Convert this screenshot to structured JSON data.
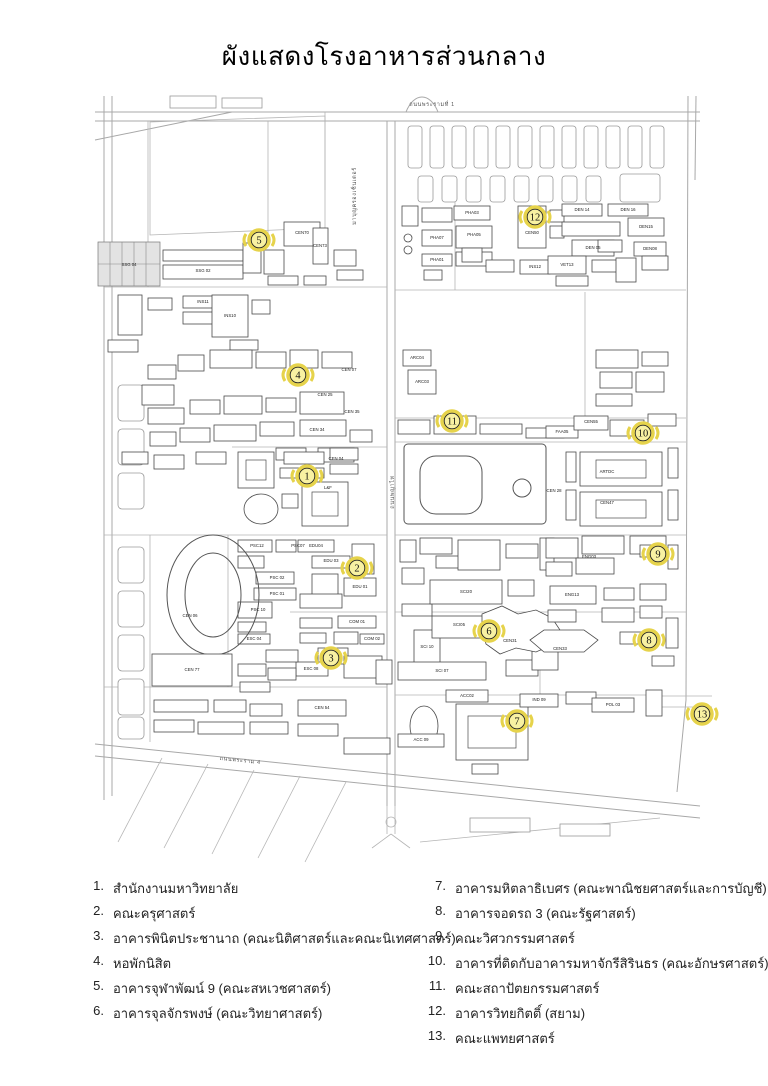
{
  "title": "ผังแสดงโรงอาหารส่วนกลาง",
  "colors": {
    "marker_fill": "#f8f1a2",
    "marker_ring": "#e6d34b",
    "marker_outline": "#222222",
    "road": "#a8a8a8",
    "ink": "#222222"
  },
  "map": {
    "street_labels": [
      {
        "text": "ถนนพระรามที่ 1",
        "x": 432,
        "y": 106,
        "rot": 0
      },
      {
        "text": "มาบุญครองเซ็นเตอร์",
        "x": 356,
        "y": 196,
        "rot": -90
      },
      {
        "text": "ถนนพญาไท",
        "x": 394,
        "y": 492,
        "rot": -90
      },
      {
        "text": "ถนนพระราม 4",
        "x": 240,
        "y": 762,
        "rot": 6
      }
    ],
    "building_labels": [
      {
        "text": "SSG 04",
        "x": 129,
        "y": 266
      },
      {
        "text": "SSG 02",
        "x": 203,
        "y": 272
      },
      {
        "text": "CEN70",
        "x": 302,
        "y": 234
      },
      {
        "text": "CEN73",
        "x": 320,
        "y": 247
      },
      {
        "text": "INS11",
        "x": 203,
        "y": 303
      },
      {
        "text": "INS10",
        "x": 230,
        "y": 317
      },
      {
        "text": "CEN 07",
        "x": 349,
        "y": 371
      },
      {
        "text": "CEN 25",
        "x": 325,
        "y": 396
      },
      {
        "text": "CEN 35",
        "x": 352,
        "y": 413
      },
      {
        "text": "CEN 34",
        "x": 317,
        "y": 431
      },
      {
        "text": "CEN 04",
        "x": 336,
        "y": 460
      },
      {
        "text": "L&F",
        "x": 328,
        "y": 489
      },
      {
        "text": "EDU04",
        "x": 316,
        "y": 547
      },
      {
        "text": "EDU 03",
        "x": 331,
        "y": 562
      },
      {
        "text": "EDU 01",
        "x": 360,
        "y": 588
      },
      {
        "text": "COM 01",
        "x": 357,
        "y": 623
      },
      {
        "text": "COM 02",
        "x": 372,
        "y": 640
      },
      {
        "text": "ESC 08",
        "x": 311,
        "y": 670
      },
      {
        "text": "CEN 54",
        "x": 322,
        "y": 709
      },
      {
        "text": "CEN 06",
        "x": 190,
        "y": 617
      },
      {
        "text": "CEN 77",
        "x": 192,
        "y": 671
      },
      {
        "text": "PSC12",
        "x": 257,
        "y": 547
      },
      {
        "text": "PSC07",
        "x": 298,
        "y": 547
      },
      {
        "text": "PSC 02",
        "x": 277,
        "y": 579
      },
      {
        "text": "PSC 01",
        "x": 277,
        "y": 595
      },
      {
        "text": "PSC 10",
        "x": 258,
        "y": 611
      },
      {
        "text": "ESC 04",
        "x": 254,
        "y": 640
      },
      {
        "text": "PHA03",
        "x": 472,
        "y": 214
      },
      {
        "text": "PHA07",
        "x": 437,
        "y": 239
      },
      {
        "text": "PHA05",
        "x": 474,
        "y": 236
      },
      {
        "text": "PHA01",
        "x": 437,
        "y": 261
      },
      {
        "text": "CEN50",
        "x": 532,
        "y": 234
      },
      {
        "text": "DEN 14",
        "x": 582,
        "y": 211
      },
      {
        "text": "DEN 16",
        "x": 628,
        "y": 211
      },
      {
        "text": "DEN15",
        "x": 646,
        "y": 228
      },
      {
        "text": "DEN08",
        "x": 650,
        "y": 250
      },
      {
        "text": "DEN 05",
        "x": 593,
        "y": 249
      },
      {
        "text": "VET13",
        "x": 567,
        "y": 266
      },
      {
        "text": "INS12",
        "x": 535,
        "y": 268
      },
      {
        "text": "ARC04",
        "x": 417,
        "y": 359
      },
      {
        "text": "ARC03",
        "x": 422,
        "y": 383
      },
      {
        "text": "CEN55",
        "x": 591,
        "y": 423
      },
      {
        "text": "FAA05",
        "x": 562,
        "y": 433
      },
      {
        "text": "CEN 28",
        "x": 554,
        "y": 492
      },
      {
        "text": "ARTDC",
        "x": 607,
        "y": 473
      },
      {
        "text": "CEN47",
        "x": 607,
        "y": 504
      },
      {
        "text": "SCI20",
        "x": 466,
        "y": 593
      },
      {
        "text": "SCI05",
        "x": 459,
        "y": 626
      },
      {
        "text": "SCI 10",
        "x": 427,
        "y": 648
      },
      {
        "text": "SCI 07",
        "x": 442,
        "y": 672
      },
      {
        "text": "CEN31",
        "x": 510,
        "y": 642
      },
      {
        "text": "ENG03",
        "x": 589,
        "y": 558
      },
      {
        "text": "ENG13",
        "x": 572,
        "y": 596
      },
      {
        "text": "CEN33",
        "x": 560,
        "y": 650
      },
      {
        "text": "ACC02",
        "x": 467,
        "y": 697
      },
      {
        "text": "ACC 09",
        "x": 421,
        "y": 741
      },
      {
        "text": "IND 09",
        "x": 539,
        "y": 701
      },
      {
        "text": "POL 03",
        "x": 613,
        "y": 706
      }
    ],
    "markers": [
      {
        "n": "1",
        "x": 307,
        "y": 476
      },
      {
        "n": "2",
        "x": 357,
        "y": 568
      },
      {
        "n": "3",
        "x": 331,
        "y": 658
      },
      {
        "n": "4",
        "x": 298,
        "y": 375
      },
      {
        "n": "5",
        "x": 259,
        "y": 240
      },
      {
        "n": "6",
        "x": 489,
        "y": 631
      },
      {
        "n": "7",
        "x": 517,
        "y": 721
      },
      {
        "n": "8",
        "x": 649,
        "y": 640
      },
      {
        "n": "9",
        "x": 658,
        "y": 554
      },
      {
        "n": "10",
        "x": 643,
        "y": 433
      },
      {
        "n": "11",
        "x": 452,
        "y": 421
      },
      {
        "n": "12",
        "x": 535,
        "y": 217
      },
      {
        "n": "13",
        "x": 702,
        "y": 714
      }
    ]
  },
  "legend": {
    "left": [
      {
        "n": "1.",
        "text": "สำนักงานมหาวิทยาลัย"
      },
      {
        "n": "2.",
        "text": "คณะครุศาสตร์"
      },
      {
        "n": "3.",
        "text": "อาคารพินิตประชานาถ (คณะนิติศาสตร์และคณะนิเทศศาสตร์)"
      },
      {
        "n": "4.",
        "text": "หอพักนิสิต"
      },
      {
        "n": "5.",
        "text": "อาคารจุฬาพัฒน์ 9 (คณะสหเวชศาสตร์)"
      },
      {
        "n": "6.",
        "text": "อาคารจุลจักรพงษ์ (คณะวิทยาศาสตร์)"
      }
    ],
    "right": [
      {
        "n": "7.",
        "text": "อาคารมหิตลาธิเบศร (คณะพาณิชยศาสตร์และการบัญชี)"
      },
      {
        "n": "8.",
        "text": "อาคารจอดรถ 3 (คณะรัฐศาสตร์)"
      },
      {
        "n": "9.",
        "text": "คณะวิศวกรรมศาสตร์"
      },
      {
        "n": "10.",
        "text": "อาคารที่ติดกับอาคารมหาจักรีสิรินธร (คณะอักษรศาสตร์)"
      },
      {
        "n": "11.",
        "text": "คณะสถาปัตยกรรมศาสตร์"
      },
      {
        "n": "12.",
        "text": "อาคารวิทยกิตติ์ (สยาม)"
      },
      {
        "n": "13.",
        "text": "คณะแพทยศาสตร์"
      }
    ]
  }
}
